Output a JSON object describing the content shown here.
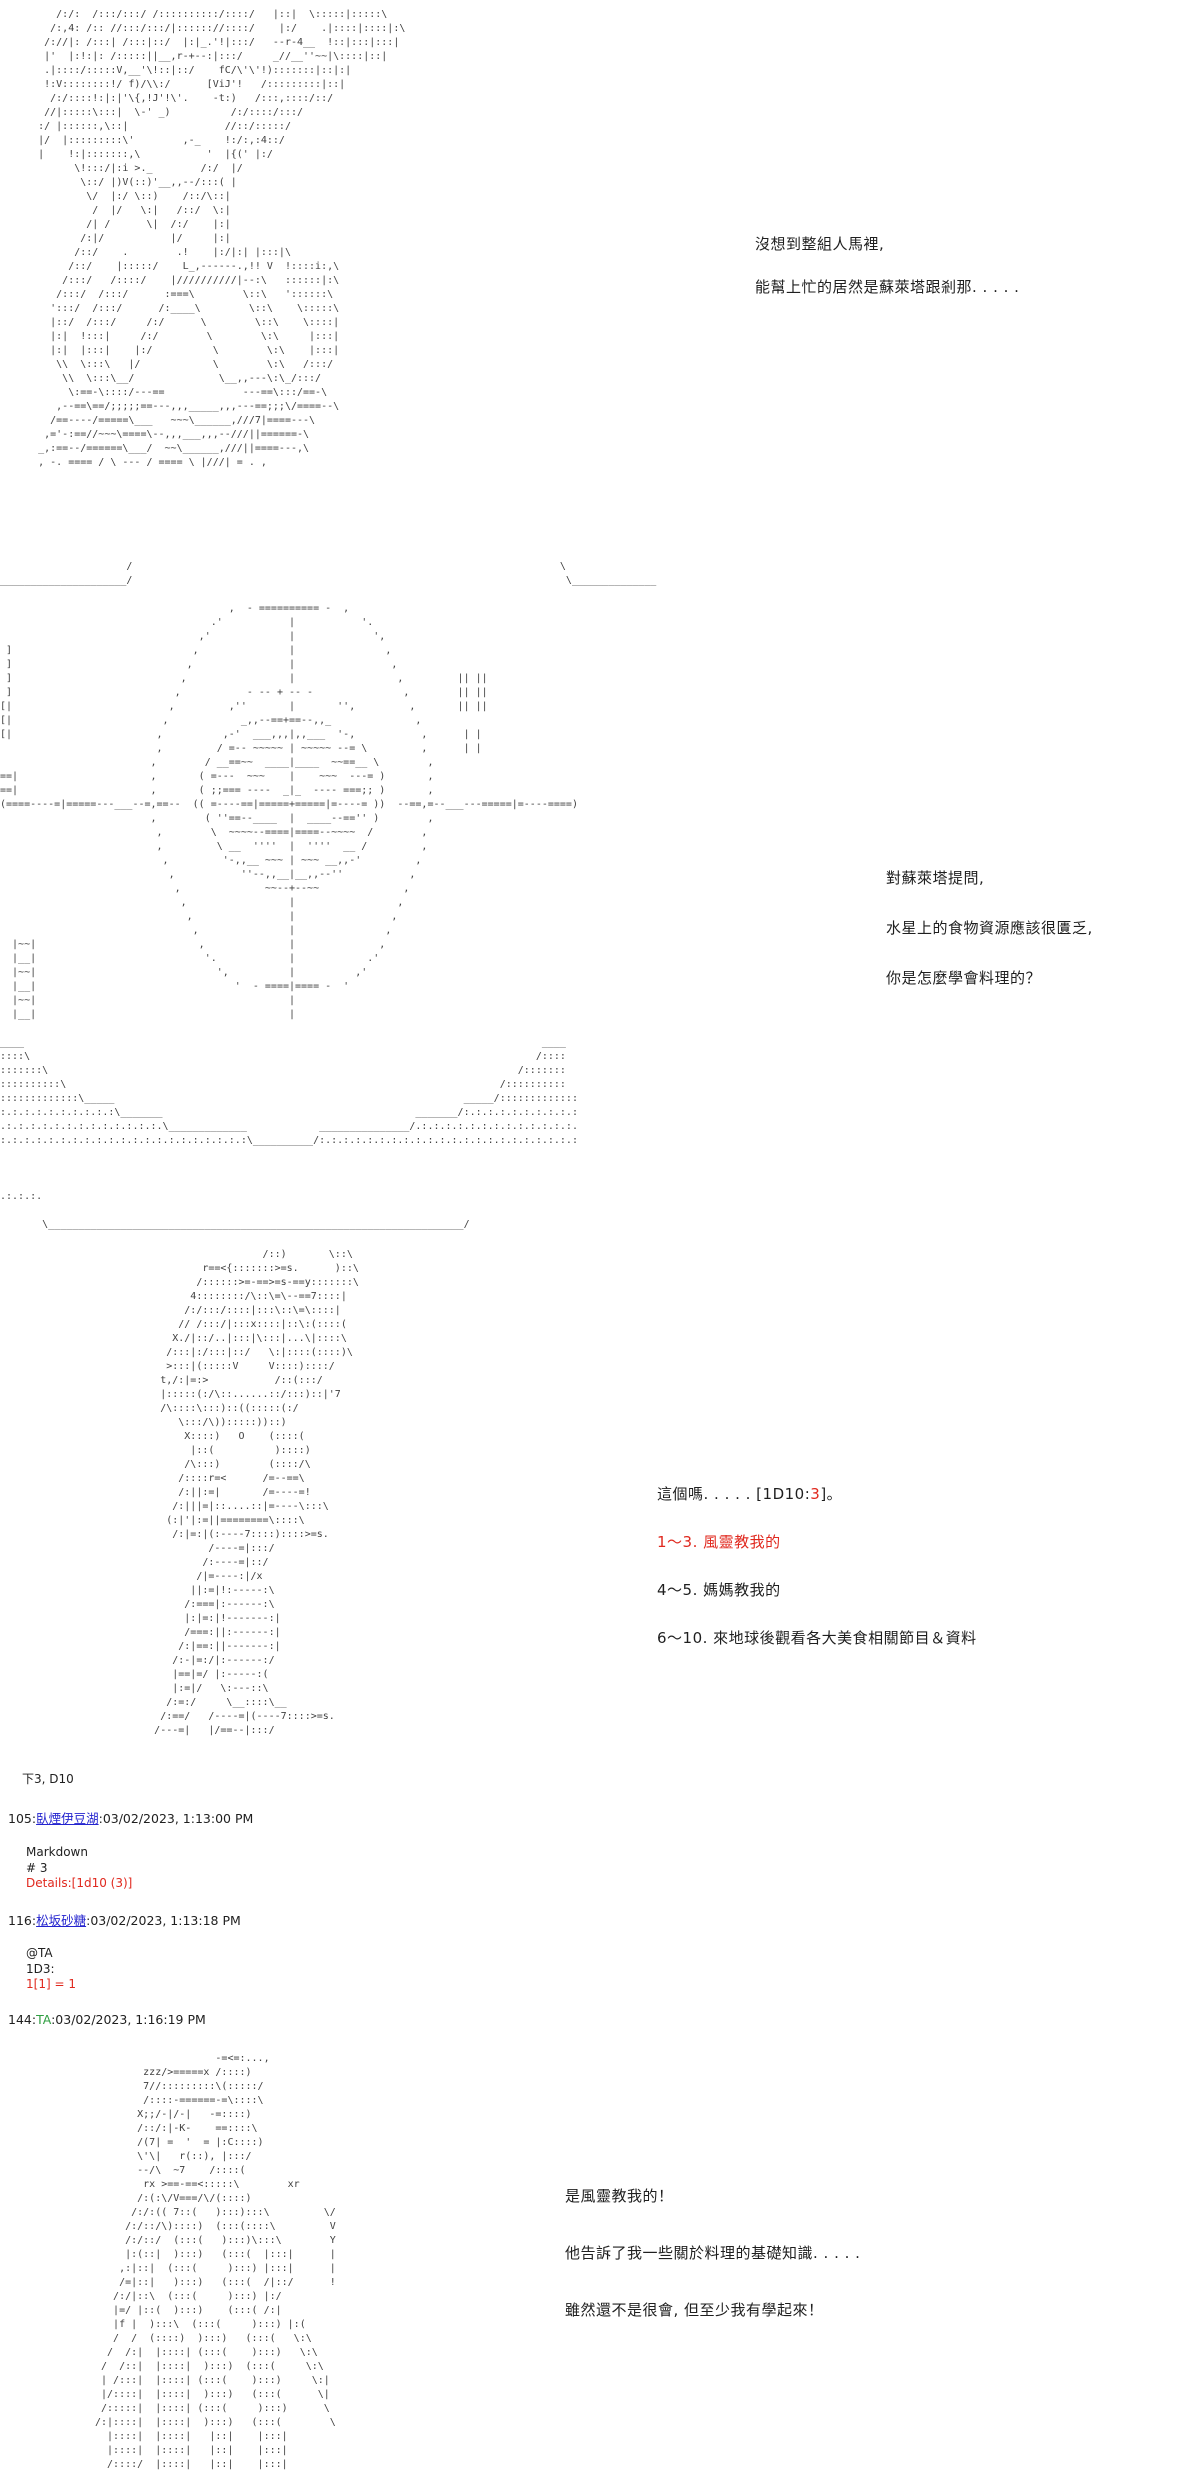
{
  "colors": {
    "background": "#ffffff",
    "text": "#1f1f1f",
    "ascii_art": "#3f3f3f",
    "highlight_red": "#e0281e",
    "link_blue": "#2424cf",
    "system_green": "#2f9e41"
  },
  "dialogues": {
    "d1": {
      "lines": [
        "沒想到整組人馬裡,",
        "能幫上忙的居然是蘇萊塔跟剎那. . . . ."
      ]
    },
    "d2": {
      "lines": [
        "對蘇萊塔提問,",
        "水星上的食物資源應該很匱乏,",
        "你是怎麼學會料理的？"
      ]
    },
    "d3": {
      "intro_prefix": "這個嗎. . . . . [1D10:",
      "roll_value": "3",
      "intro_suffix": "]。",
      "options": [
        {
          "label": "1～3. 風靈教我的",
          "highlight": true
        },
        {
          "label": "4～5. 媽媽教我的",
          "highlight": false
        },
        {
          "label": "6～10. 來地球後觀看各大美食相關節目＆資料",
          "highlight": false
        }
      ]
    },
    "d4": {
      "lines": [
        "是風靈教我的！",
        "他告訴了我一些關於料理的基礎知識. . . . .",
        "雖然還不是很會, 但至少我有學起來！"
      ]
    }
  },
  "dice_log": {
    "note": "下3, D10",
    "posts": [
      {
        "no": "105:",
        "name": "臥煙伊豆湖",
        "sep": ":",
        "time": "03/02/2023, 1:13:00 PM",
        "body_line1": "Markdown",
        "body_line2": "# 3",
        "body_line3": "Details:[1d10 (3)]"
      },
      {
        "no": "116:",
        "name": "松坂砂糖",
        "sep": ":",
        "time": "03/02/2023, 1:13:18 PM",
        "body_line1": "@TA",
        "body_line2": "1D3:",
        "body_line3": "1[1] = 1"
      },
      {
        "no": "144:",
        "name": "TA",
        "sep": ":",
        "time": "03/02/2023, 1:16:19 PM"
      }
    ]
  },
  "ascii_art": {
    "narrator_character": [
      "        /:/:  /:::/:::/ /::::::::::/::::/   |::|  \\:::::|:::::\\",
      "       /:,4: /:: //:::/:::/|:::::://::::/    |:/    .|::::|::::|:\\",
      "      /://|: /:::| /:::|::/  |:|_.'!|:::/   --r-4__  !::|:::|:::|",
      "      |'  |:!:|: /:::::||__,r-+--:|:::/     _//__''~~|\\::::|::|",
      "      .|::::/:::::V,__'\\!::|::/    fC/\\'\\'!):::::::|::|:|",
      "      !:V::::::::!/ f)/\\\\:/      [ViJ'!   /:::::::::|::|",
      "       /:/::::!:|:|'\\{,!J'!\\'.    -t:)   /:::,::::/::/",
      "      //|:::::\\:::|  \\-' _)          /:/::::/:::/",
      "     :/ |::::::,\\::|                //::/:::::/",
      "     |/  |:::::::::\\'        ,-_    !:/:,:4::/",
      "     |    !:|:::::::,\\           '  |{(' |:/",
      "           \\!:::/|:i >._        /:/  |/",
      "            \\::/ |)V(::)'__,,--/:::( |",
      "             \\/  |:/ \\::)    /::/\\::|",
      "              /  |/   \\:|   /::/  \\:|",
      "             /| /      \\|  /:/    |:|",
      "            /:|/           |/     |:|",
      "           /::/    .        .!    |:/|:| |:::|\\",
      "          /::/    |:::::/    L_,------.,!! V  !::::i:,\\",
      "         /:::/   /::::/    |//////////|--:\\   ::::::|:\\",
      "        /:::/  /:::/      :===\\        \\::\\   '::::::\\",
      "       ':::/  /:::/      /:____\\        \\::\\    \\:::::\\",
      "       |::/  /:::/     /:/      \\        \\::\\    \\::::|",
      "       |:|  !:::|     /:/        \\        \\:\\     |:::|",
      "       |:|  |:::|    |:/          \\        \\:\\    |:::|",
      "        \\\\  \\:::\\   |/            \\        \\:\\   /:::/",
      "         \\\\  \\:::\\__/              \\__,,---\\:\\_/:::/",
      "          \\:==-\\::::/---==             ---==\\:::/==-\\",
      "        ,--==\\==/;;;;;==---,,,_____,,,---==;;;\\/====--\\",
      "       /==----/=====\\___   ~~~\\______,///7|====---\\",
      "      ,='-:==//~~~\\====\\--,,,___,,,--///||======-\\",
      "     _,:==--/======\\___/  ~~\\______,///||====---,\\",
      "     , -. ==== / \\ --- / ==== \\ |///| = . ,"
    ],
    "mercury_planet": [
      "                     /                                                                       \\",
      "_____________________/                                                                        \\______________",
      "",
      "                                      ,  - ========== -  ,",
      "                                   .'           |           '.",
      "                                 ,'             |             ',",
      " ]                              ,               |               ,",
      " ]                             ,                |                ,",
      " ]                            ,                 |                 ,         || ||",
      " ]                           ,           - -- + -- -               ,        || ||",
      "[|                          ,         ,''       |       '',         ,       || ||",
      "[|                         ,            _,,--==+==--,,_              ,",
      "[|                        ,          ,-'  ___,,,|,,___  '-,           ,      | |",
      "                          ,         / =-- ~~~~~ | ~~~~~ --= \\         ,      | |",
      "                         ,        / __==~~  ____|____  ~~==__ \\        ,",
      "==|                      ,       ( =---  ~~~    |    ~~~  ---= )       ,",
      "==|                      ,       ( ;;=== ----  _|_  ---- ===;; )       ,",
      "(====----=|=====---___--=,==--  (( =----==|=====+=====|=----= ))  --==,=--___---=====|=----====)",
      "                         ,        ( ''==--____  |  ____--=='' )        ,",
      "                          ,        \\  ~~~~--====|====--~~~~  /        ,",
      "                          ,         \\ __  ''''  |  ''''  __ /         ,",
      "                           ,         '-,,__ ~~~ | ~~~ __,,-'         ,",
      "                            ,           ''--,,__|__,,--''           ,",
      "                             ,              ~~--+--~~              ,",
      "                              ,                 |                 ,",
      "                               ,                |                ,",
      "                                ,               |               ,",
      "  |~~|                           ,              |              ,",
      "  |__|                            '.            |            .'",
      "  |~~|                              ',          |          ,'",
      "  |__|                                 '  - ====|==== -  '",
      "  |~~|                                          |",
      "  |__|                                          |",
      "",
      "____                                                                                      ____",
      "::::\\                                                                                    /::::",
      ":::::::\\                                                                              /:::::::",
      "::::::::::\\                                                                        /::::::::::",
      ":::::::::::::\\_____                                                          _____/:::::::::::::",
      ":.:.:.:.:.:.:.:.:.:\\_______                                          _______/:.:.:.:.:.:.:.:.:.:",
      ".:.:.:.:.:.:.:.:.:.:.:.:.:.\\_____________            _______________/.:.:.:.:.:.:.:.:.:.:.:.:.:.",
      ":.:.:.:.:.:.:.:.:.:.:.:.:.:.:.:.:.:.:.:.:\\__________/:.:.:.:.:.:.:.:.:.:.:.:.:.:.:.:.:.:.:.:.:.:",
      "",
      "",
      "",
      ".:.:.:.",
      "",
      "       \\_____________________________________________________________________/"
    ],
    "suletta_answer": [
      "                           /::)       \\::\\",
      "                 r==<{:::::::>=s.      )::\\",
      "                /::::::>=-==>=s-==y:::::::\\",
      "               4::::::::/\\::\\=\\--==7::::|",
      "              /:/:::/::::|:::\\::\\=\\::::|",
      "             // /:::/|:::x::::|::\\:(::::(",
      "            X./|::/..|:::|\\:::|...\\|::::\\",
      "           /:::|:/:::|::/   \\:|::::(::::)\\",
      "           >:::|(:::::V     V::::)::::/",
      "          t,/:|=:>           /::(:::/",
      "          |:::::(:/\\::......::/:::)::|'7",
      "          /\\::::\\:::)::((:::::(:/",
      "             \\:::/\\)):::::))::)",
      "              X::::)   O    (::::(",
      "               |::(          )::::)",
      "              /\\:::)        (::::/\\",
      "             /::::r=<      /=--==\\",
      "             /:||:=|       /=----=!",
      "            /:|||=|::....::|=----\\:::\\",
      "           (:|'|:=||========\\::::\\",
      "            /:|=:|(:----7::::)::::>=s.",
      "                  /----=|:::/",
      "                 /:----=|::/",
      "                /|=----:|/x",
      "               ||:=|!:-----:\\",
      "              /:===|:------:\\",
      "              |:|=:|!-------:|",
      "              /===:||:------:|",
      "             /:|==:||-------:|",
      "            /:-|=:/|:------:/",
      "            |==|=/ |:-----:(",
      "            |:=|/   \\:---::\\",
      "           /:=:/     \\__::::\\__",
      "          /:==/   /----=|(----7::::>=s.",
      "         /---=|   |/==--|:::/"
    ],
    "suletta_talking": [
      "                    -=<=:...,",
      "        zzz/>=====x /::::)",
      "        7//:::::::::\\(:::::/",
      "        /::::-======-=\\::::\\",
      "       X;;/-|/-|   -=::::)",
      "       /::/:|-K-    ==::::\\",
      "       /(7| =  '  = |:C::::)",
      "       \\'\\|   r(::), |:::/",
      "       --/\\  ~7    /::::(",
      "        rx >==-==<:::::\\        xr",
      "       /:(:\\/V===/\\/(::::)",
      "      /:/:(( 7::(   ):::):::\\         \\/",
      "     /:/::/\\)::::)  (:::(::::\\         V",
      "     /:/::/  (:::(   ):::)\\:::\\        Y",
      "     |:(::|  ):::)   (:::(  |:::|      |",
      "    ,:|::|  (:::(     ):::) |:::|      |",
      "    /=|::|   ):::)   (:::(  /|::/      !",
      "   /:/|::\\  (:::(     ):::) |:/",
      "   |=/ |::(  ):::)    (:::( /:|",
      "   |f |  ):::\\  (:::(     ):::) |:(",
      "   /  /  (::::)  ):::)   (:::(   \\:\\",
      "  /  /:|  |::::| (:::(    ):::)   \\:\\",
      " /  /::|  |::::|  ):::)  (:::(     \\:\\",
      " | /:::|  |::::| (:::(    ):::)     \\:|",
      " |/::::|  |::::|  ):::)   (:::(      \\|",
      " /:::::|  |::::| (:::(     ):::)      \\",
      "/:|::::|  |::::|  ):::)   (:::(        \\",
      "  |::::|  |::::|   |::|    |:::|",
      "  |::::|  |::::|   |::|    |:::|",
      "  /::::/  |::::|   |::|    |:::|"
    ]
  }
}
